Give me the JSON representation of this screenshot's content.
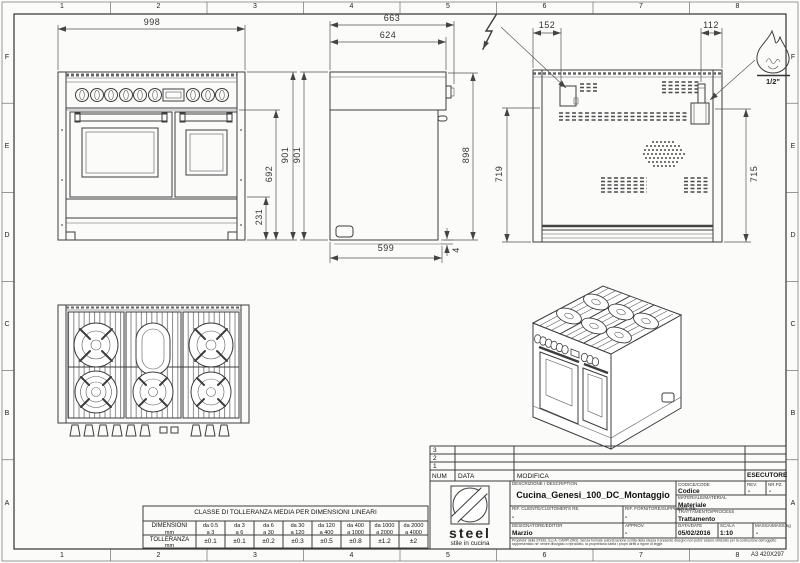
{
  "sheet": {
    "border_columns": [
      "1",
      "2",
      "3",
      "4",
      "5",
      "6",
      "7",
      "8"
    ],
    "border_rows": [
      "F",
      "E",
      "D",
      "C",
      "B",
      "A"
    ],
    "format_label": "A3 420X297"
  },
  "views": {
    "front": {
      "dim_width": "998",
      "dim_height_total": "901",
      "dim_height_oven": "692",
      "dim_height_plinth": "231"
    },
    "side": {
      "dim_depth_total": "663",
      "dim_depth_top": "624",
      "dim_height_total": "901",
      "dim_height_back": "898",
      "dim_depth_base": "599",
      "dim_base_gap": "4"
    },
    "back": {
      "dim_elec_offset": "152",
      "dim_gas_offset": "112",
      "dim_elec_height": "719",
      "dim_gas_height": "715",
      "gas_size_label": "1/2\""
    }
  },
  "tolerance_table": {
    "title": "CLASSE DI TOLLERANZA MEDIA PER DIMENSIONI LINEARI",
    "dim_label": "DIMENSIONI",
    "dim_unit": "mm",
    "tol_label": "TOLLERANZA",
    "tol_unit": "mm",
    "ranges": [
      {
        "from": "da 0.5",
        "to": "a 3"
      },
      {
        "from": "da 3",
        "to": "a 6"
      },
      {
        "from": "da 6",
        "to": "a 30"
      },
      {
        "from": "da 30",
        "to": "a 120"
      },
      {
        "from": "da 120",
        "to": "a 400"
      },
      {
        "from": "da 400",
        "to": "a 1000"
      },
      {
        "from": "da 1000",
        "to": "a 2000"
      },
      {
        "from": "da 2000",
        "to": "a 4000"
      }
    ],
    "values": [
      "±0.1",
      "±0.1",
      "±0.2",
      "±0.3",
      "±0.5",
      "±0.8",
      "±1.2",
      "±2"
    ]
  },
  "title_block": {
    "revision_rows": [
      "3",
      "2",
      "1"
    ],
    "num_header": "NUM",
    "date_header": "DATA",
    "change_header": "MODIFICA",
    "executor_header": "ESECUTORE",
    "logo_name": "steel",
    "logo_tagline": "stile in cucina",
    "description_label": "DESCRIZIONE / DESCRIPTION",
    "description": "Cucina_Genesi_100_DC_Montaggio",
    "customer_ref_label": "RIF. CLIENTE/CUSTOMER'S RE.",
    "customer_ref": "-",
    "supplier_ref_label": "RIF. FORNITORE/SUPPLIER'S RE.",
    "supplier_ref": "-",
    "editor_label": "DESIGNATORE/EDITOR",
    "editor": "Marzio",
    "approval_label": "APPROV.",
    "approval": "-",
    "code_label": "CODICE/CODE",
    "code": "Codice",
    "rev_label": "REV.",
    "rev": "-",
    "pieces_label": "NR.PZ.",
    "pieces": "-",
    "material_label": "MATERIALE/MATERIAL",
    "material": "Materiale",
    "process_label": "TRATTAMENTO/PROCESS",
    "process": "Trattamento",
    "date_label": "DATA/DATE",
    "date": "05/02/2016",
    "scale_label": "SCALA",
    "scale": "1:10",
    "mass_label": "MASSA/MASS kg",
    "mass": "-",
    "legal": "Proprieta' della STEEL S.p.A. CARPI (MO). Senza formale autorizzazione scritta della stessa il presente disegno non potra' essere utilizzato per la costruzione dell'oggetto rappresentato ne' venire divulgato o riprodotto, la proprietaria tutela i propri diritti a rigore di legge."
  }
}
